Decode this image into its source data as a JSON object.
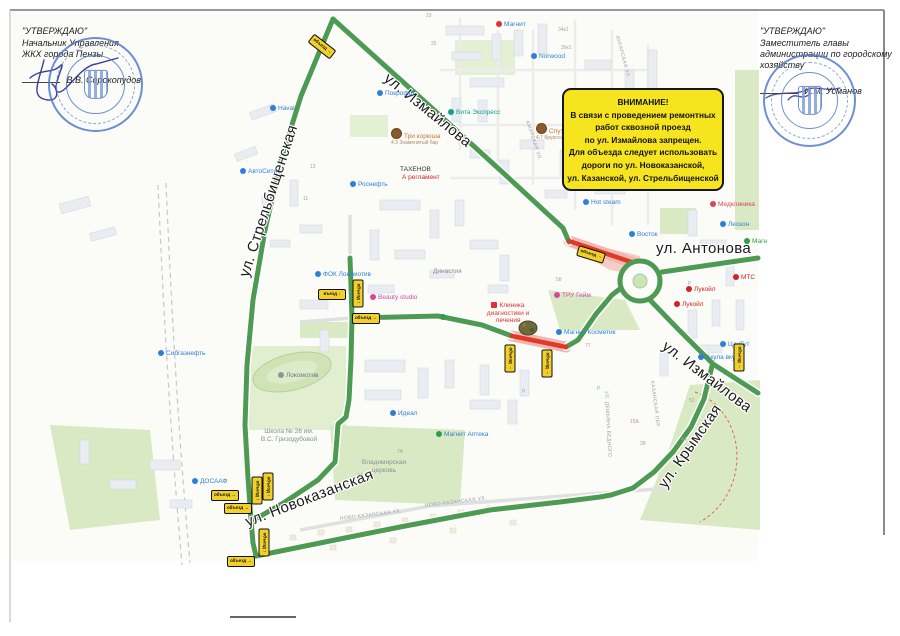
{
  "approvals": {
    "left": {
      "title": "\"УТВЕРЖДАЮ\"",
      "role1": "Начальник Управления",
      "role2": "ЖКХ города Пензы",
      "signer": "В.В. Сорокопудов"
    },
    "right": {
      "title": "\"УТВЕРЖДАЮ\"",
      "role1": "Заместитель главы",
      "role2": "администрации по городскому",
      "role3": "хозяйству",
      "signer": "И.М. Усманов"
    }
  },
  "notice": {
    "lines": [
      "ВНИМАНИЕ!",
      "В связи с проведением ремонтных",
      "работ сквозной проезд",
      "по ул. Измайлова запрещен.",
      "Для объезда следует использовать",
      "дороги по ул. Новоказанской,",
      "ул. Казанской, ул. Стрельбищенской"
    ]
  },
  "streets": {
    "izmailova": "ул. Измайлова",
    "strelbishchenskaya": "ул. Стрельбищенская",
    "antonova": "ул. Антонова",
    "krymskaya": "ул. Крымская",
    "novokazanskaya": "ул. Новоказанская"
  },
  "minor_streets": [
    {
      "t": "НОВО-КАЗАНСКАЯ УЛ.",
      "x": 340,
      "y": 516,
      "r": -7,
      "c": "#9aa0a8"
    },
    {
      "t": "НОВО-КАЗАНСКАЯ УЛ.",
      "x": 425,
      "y": 503,
      "r": -7,
      "c": "#9aa0a8"
    },
    {
      "t": "АНГАРСКАЯ УЛ.",
      "x": 617,
      "y": 33,
      "r": 75,
      "c": "#9aa0a8"
    },
    {
      "t": "АМУРСКАЯ УЛ.",
      "x": 527,
      "y": 118,
      "r": 72,
      "c": "#9aa0a8"
    },
    {
      "t": "КАЗАНСКАЯ ПЕР.",
      "x": 652,
      "y": 378,
      "r": 83,
      "c": "#9aa0a8"
    },
    {
      "t": "УЛ. ДЕМЬЯНА БЕДНОГО",
      "x": 606,
      "y": 388,
      "r": 87,
      "c": "#9aa0a8"
    },
    {
      "t": "Р",
      "x": 597,
      "y": 386,
      "r": 0,
      "c": "#93a7cf"
    },
    {
      "t": "Р",
      "x": 522,
      "y": 389,
      "r": 0,
      "c": "#93a7cf"
    },
    {
      "t": "Р",
      "x": 688,
      "y": 281,
      "r": 0,
      "c": "#93a7cf"
    }
  ],
  "house_numbers": [
    {
      "t": "23",
      "x": 426,
      "y": 13
    },
    {
      "t": "25",
      "x": 431,
      "y": 41
    },
    {
      "t": "34к1",
      "x": 558,
      "y": 27
    },
    {
      "t": "36к1",
      "x": 561,
      "y": 45
    },
    {
      "t": "13",
      "x": 310,
      "y": 164
    },
    {
      "t": "11",
      "x": 303,
      "y": 196
    },
    {
      "t": "58",
      "x": 556,
      "y": 277
    },
    {
      "t": "77",
      "x": 585,
      "y": 343
    },
    {
      "t": "7А",
      "x": 397,
      "y": 449
    },
    {
      "t": "15А",
      "x": 630,
      "y": 419
    },
    {
      "t": "44",
      "x": 681,
      "y": 437
    },
    {
      "t": "52",
      "x": 689,
      "y": 398
    },
    {
      "t": "2А",
      "x": 357,
      "y": 473
    },
    {
      "t": "38",
      "x": 640,
      "y": 441
    }
  ],
  "pois": [
    {
      "name": "Покрофф",
      "x": 377,
      "y": 90,
      "c": "#2f7fd9",
      "ic": "#2f7fd9"
    },
    {
      "name": "Три корюша",
      "x": 391,
      "y": 128,
      "c": "#c9762e",
      "ic": "photo",
      "sub": "4,3 Знаменитый бар"
    },
    {
      "name": "Роснефть",
      "x": 350,
      "y": 181,
      "c": "#2f7fd9",
      "ic": "#2f7fd9"
    },
    {
      "name": "Магнит",
      "x": 496,
      "y": 21,
      "c": "#2f7fd9",
      "ic": "#e03232"
    },
    {
      "name": "Norwood",
      "x": 531,
      "y": 53,
      "c": "#2f7fd9",
      "ic": "#2f7fd9"
    },
    {
      "name": "Вита Экспресс",
      "x": 448,
      "y": 109,
      "c": "#11a08c",
      "ic": "#11a08c"
    },
    {
      "name": "Спутб",
      "x": 536,
      "y": 123,
      "c": "#c9762e",
      "ic": "photo",
      "sub": "4,7 Круассаны"
    },
    {
      "name": "Hot steam",
      "x": 583,
      "y": 199,
      "c": "#2f7fd9",
      "ic": "#2f7fd9"
    },
    {
      "name": "Восток",
      "x": 629,
      "y": 231,
      "c": "#2f7fd9",
      "ic": "#2f7fd9"
    },
    {
      "name": "Медклиника",
      "x": 710,
      "y": 201,
      "c": "#d9455f",
      "ic": "#d9455f"
    },
    {
      "name": "Лескон",
      "x": 720,
      "y": 221,
      "c": "#2f7fd9",
      "ic": "#2f7fd9"
    },
    {
      "name": "Магн",
      "x": 744,
      "y": 238,
      "c": "#2f9e44",
      "ic": "#2f9e44"
    },
    {
      "name": "МТС",
      "x": 733,
      "y": 274,
      "c": "#d22222",
      "ic": "#d22222"
    },
    {
      "name": "Лукойл",
      "x": 686,
      "y": 286,
      "c": "#d22222",
      "ic": "#d22222"
    },
    {
      "name": "Лукойл",
      "x": 674,
      "y": 301,
      "c": "#d22222",
      "ic": "#d22222"
    },
    {
      "name": "Акула вкуса",
      "x": 698,
      "y": 354,
      "c": "#2f7fd9",
      "ic": "#2f7fd9"
    },
    {
      "name": "ЦанГут",
      "x": 720,
      "y": 341,
      "c": "#2f7fd9",
      "ic": "#2f7fd9"
    },
    {
      "name": "Магнит Косметик",
      "x": 556,
      "y": 329,
      "c": "#2f7fd9",
      "ic": "#2f7fd9"
    },
    {
      "name": "ТРУ Гейм",
      "x": 554,
      "y": 292,
      "c": "#d24a9e",
      "ic": "#d24a9e"
    },
    {
      "name": "Клиника диагностики и лечения",
      "x": 478,
      "y": 302,
      "c": "#e03232",
      "ic": "cross",
      "w": 60
    },
    {
      "name": "Beauty studio",
      "x": 370,
      "y": 294,
      "c": "#d24a9e",
      "ic": "#d24a9e"
    },
    {
      "name": "ФОК Локомотив",
      "x": 315,
      "y": 271,
      "c": "#2f7fd9",
      "ic": "#2f7fd9"
    },
    {
      "name": "Локомотив",
      "x": 278,
      "y": 372,
      "c": "#6b7685",
      "ic": "#8b95a3"
    },
    {
      "name": "Идеал",
      "x": 390,
      "y": 410,
      "c": "#2f7fd9",
      "ic": "#2f7fd9"
    },
    {
      "name": "Магнит Аптека",
      "x": 436,
      "y": 431,
      "c": "#2f7fd9",
      "ic": "#2f9e44"
    },
    {
      "name": "Школа № 26 им. В.С. Гризодубовой",
      "x": 258,
      "y": 428,
      "c": "#8a8f98",
      "ic": "none",
      "w": 62
    },
    {
      "name": "Владимирская церковь",
      "x": 356,
      "y": 459,
      "c": "#8a8f98",
      "ic": "none",
      "w": 56
    },
    {
      "name": "ДОСААФ",
      "x": 192,
      "y": 478,
      "c": "#2f7fd9",
      "ic": "#2f7fd9"
    },
    {
      "name": "Сибгазнефть",
      "x": 158,
      "y": 350,
      "c": "#2f7fd9",
      "ic": "#2f7fd9"
    },
    {
      "name": "Haval",
      "x": 270,
      "y": 105,
      "c": "#2f7fd9",
      "ic": "#2f7fd9"
    },
    {
      "name": "АвтоСити",
      "x": 240,
      "y": 168,
      "c": "#2f7fd9",
      "ic": "#2f7fd9"
    },
    {
      "name": "Династия",
      "x": 433,
      "y": 268,
      "c": "#8a8f98",
      "ic": "none"
    },
    {
      "name": "ТАХЕНОВ",
      "x": 400,
      "y": 166,
      "c": "#333333",
      "ic": "none"
    },
    {
      "name": "А регламент",
      "x": 402,
      "y": 174,
      "c": "#d22222",
      "ic": "none"
    },
    {
      "name": "",
      "x": 440,
      "y": 314,
      "c": "#2f9e44",
      "ic": "#2f9e44"
    }
  ],
  "signs": [
    {
      "x": 321,
      "y": 45,
      "r": 38,
      "label": "объезд",
      "arrow": "→"
    },
    {
      "x": 590,
      "y": 253,
      "r": 17,
      "label": "объезд",
      "arrow": "→"
    },
    {
      "x": 738,
      "y": 356,
      "r": 90,
      "label": "объезд",
      "arrow": "→"
    },
    {
      "x": 509,
      "y": 357,
      "r": 90,
      "label": "объезд",
      "arrow": "→"
    },
    {
      "x": 546,
      "y": 362,
      "r": 90,
      "label": "объезд",
      "arrow": "→"
    },
    {
      "x": 331,
      "y": 293,
      "r": 0,
      "label": "въезд",
      "arrow": "↓"
    },
    {
      "x": 357,
      "y": 292,
      "r": 90,
      "label": "объезд",
      "arrow": "↑"
    },
    {
      "x": 365,
      "y": 317,
      "r": 0,
      "label": "объезд",
      "arrow": "→"
    },
    {
      "x": 256,
      "y": 489,
      "r": 90,
      "label": "объезд",
      "arrow": "↑"
    },
    {
      "x": 267,
      "y": 485,
      "r": 90,
      "label": "объезд",
      "arrow": "↑"
    },
    {
      "x": 224,
      "y": 494,
      "r": 0,
      "label": "объезд",
      "arrow": "→"
    },
    {
      "x": 237,
      "y": 507,
      "r": 0,
      "label": "объезд",
      "arrow": "→"
    },
    {
      "x": 263,
      "y": 541,
      "r": 90,
      "label": "объезд",
      "arrow": "↑"
    },
    {
      "x": 240,
      "y": 560,
      "r": 0,
      "label": "объезд",
      "arrow": "→"
    }
  ],
  "colors": {
    "route_green": "#4d9b52",
    "closed_red": "#dd3a28",
    "closed_pink": "#f3b6ae",
    "sign_yellow": "#f2d02a",
    "notice_yellow": "#f6e41f",
    "stamp_blue": "#4a74c8"
  }
}
